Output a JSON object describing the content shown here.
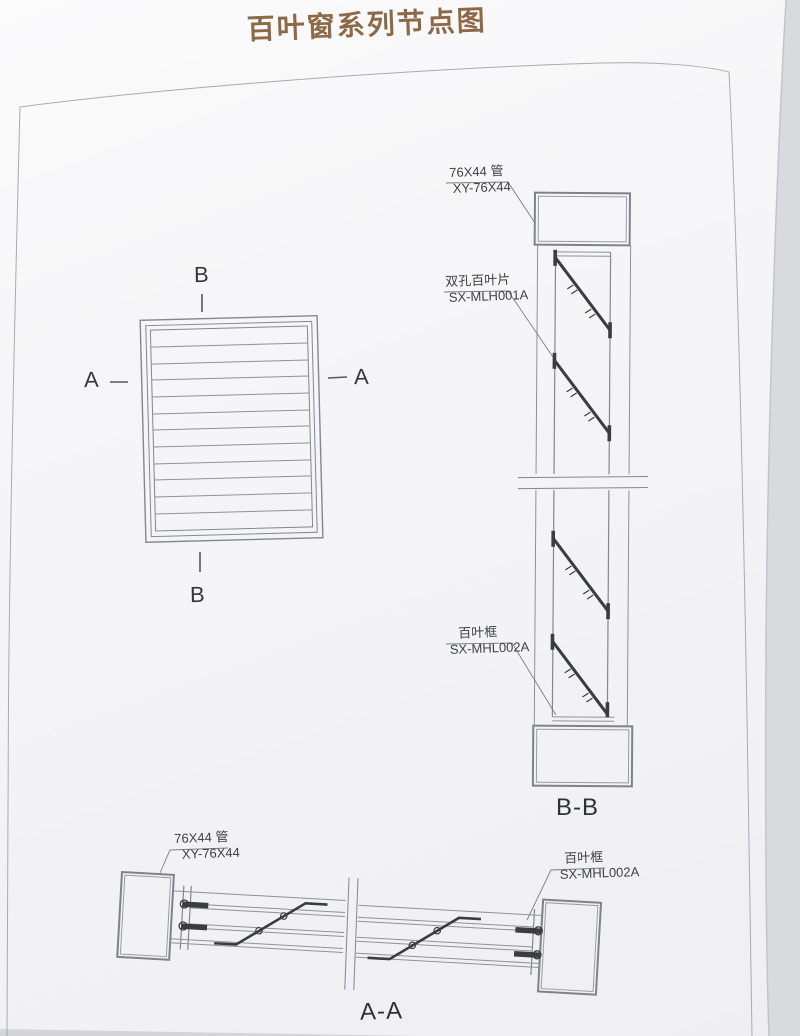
{
  "title": "百叶窗系列节点图",
  "front_view": {
    "marker_a": "A",
    "marker_b": "B"
  },
  "section_bb": {
    "caption": "B-B",
    "label_tube_1": "76X44 管",
    "label_tube_2": "XY-76X44",
    "label_blade_1": "双孔百叶片",
    "label_blade_2": "SX-MLH001A",
    "label_frame_1": "百叶框",
    "label_frame_2": "SX-MHL002A"
  },
  "section_aa": {
    "caption": "A-A",
    "label_tube_1": "76X44 管",
    "label_tube_2": "XY-76X44",
    "label_frame_1": "百叶框",
    "label_frame_2": "SX-MHL002A"
  },
  "colors": {
    "title_brown": "#8d6947",
    "drawing_line": "#84888c",
    "dark_detail": "#3a3d40",
    "page_background": "#f4f4f7",
    "photo_background": "#dddee1"
  }
}
